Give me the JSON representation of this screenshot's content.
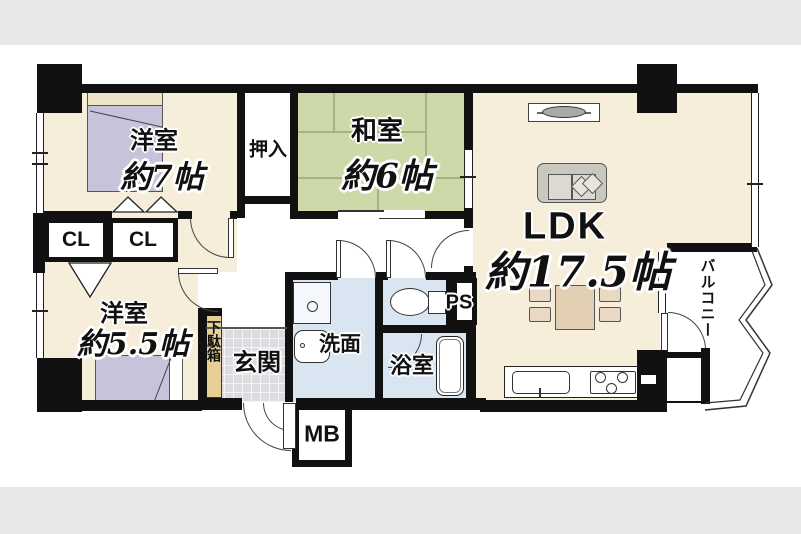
{
  "floorplan": {
    "rooms": {
      "west_bedroom_7": {
        "name": "洋室",
        "size": "約7帖"
      },
      "japanese_room": {
        "name": "和室",
        "size": "約6帖"
      },
      "ldk": {
        "name": "LDK",
        "size": "約17.5帖"
      },
      "west_bedroom_55": {
        "name": "洋室",
        "size": "約5.5帖"
      },
      "closet_left": {
        "label": "CL"
      },
      "closet_right": {
        "label": "CL"
      },
      "oshiire": {
        "label": "押入"
      },
      "genkan": {
        "label": "玄関"
      },
      "getabako": {
        "label": "下駄箱"
      },
      "washroom": {
        "label": "洗面"
      },
      "bathroom": {
        "label": "浴室"
      },
      "pipe_space": {
        "label": "PS"
      },
      "meter_box": {
        "label": "MB"
      },
      "balcony": {
        "label": "バルコニー"
      }
    },
    "colors": {
      "page_background": "#e8e8ea",
      "paper": "#ffffff",
      "wall": "#111111",
      "western_room_floor": "#f6eedb",
      "tatami_floor": "#cdd9a9",
      "wet_area_floor": "#d9e5f1",
      "bed": "#c6c3da",
      "entrance_tile": "#dcdce0",
      "shoe_cabinet": "#e6d096"
    }
  }
}
